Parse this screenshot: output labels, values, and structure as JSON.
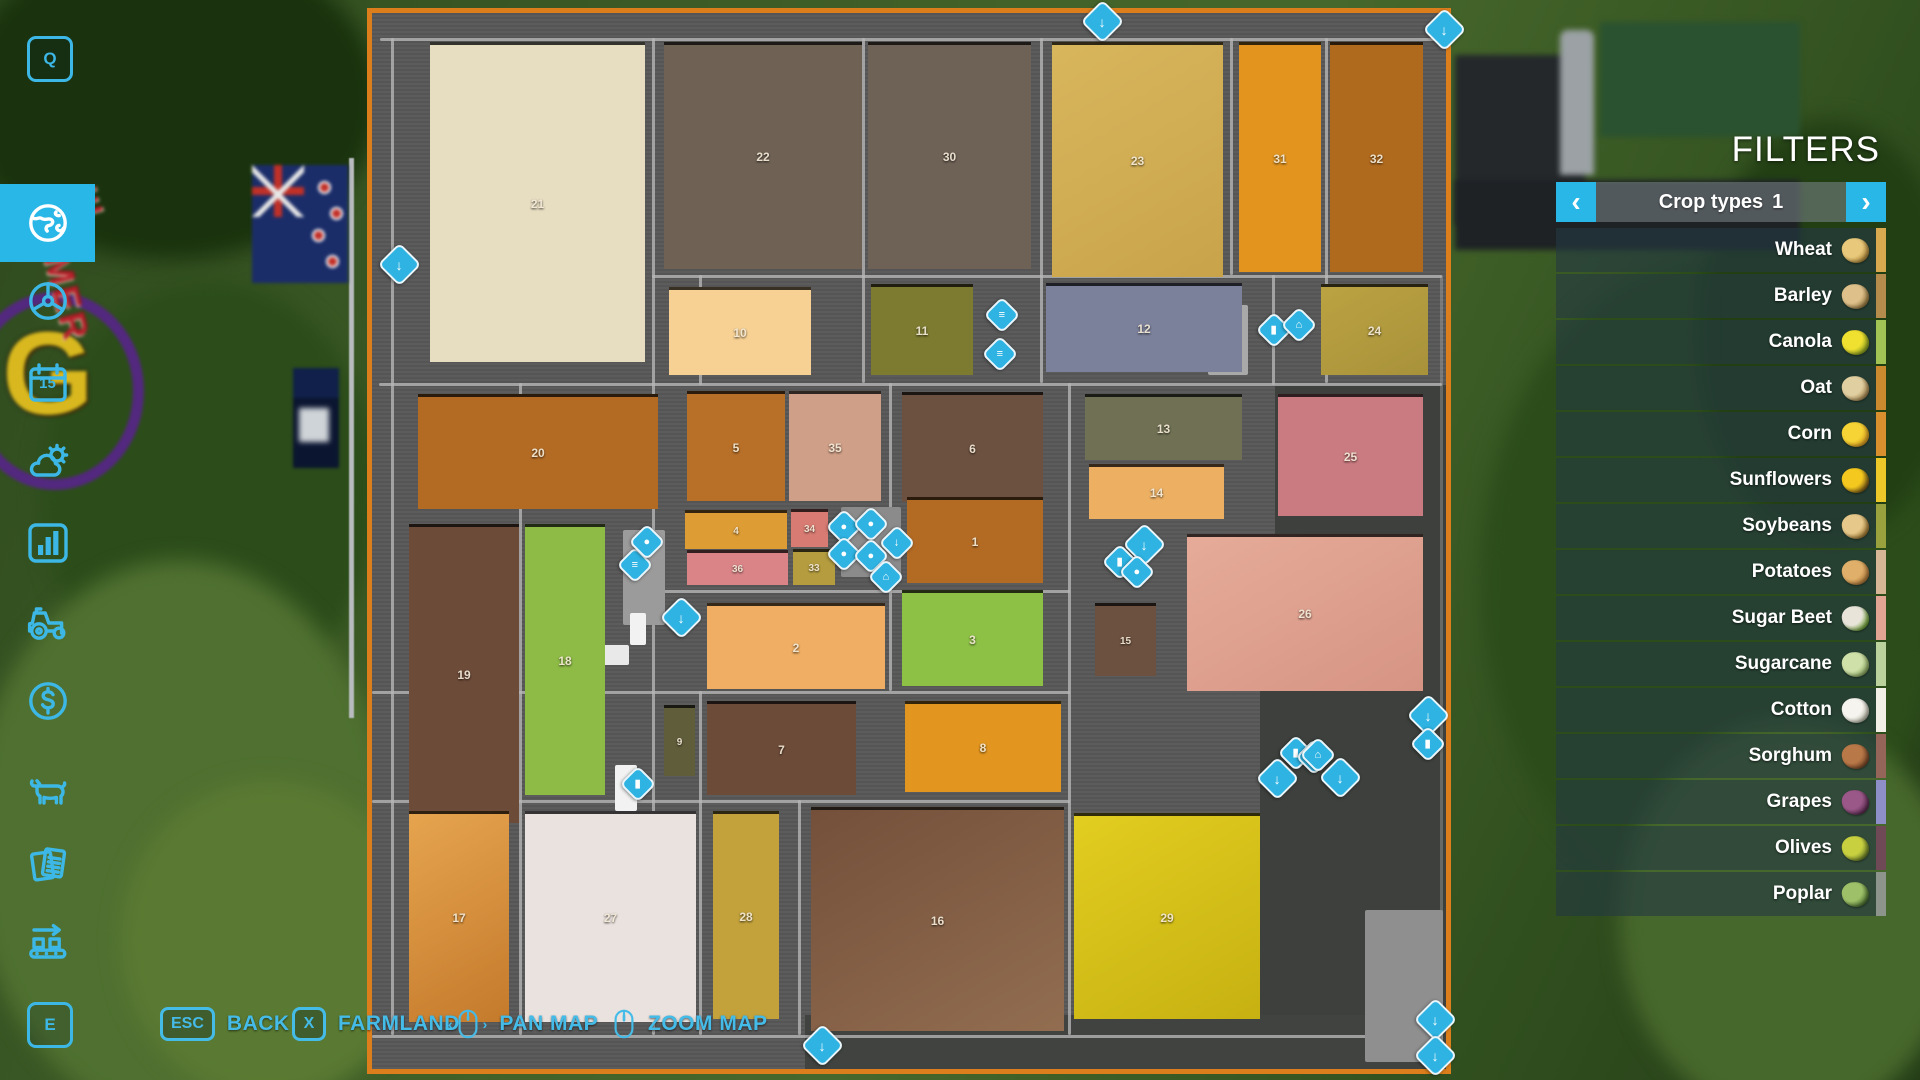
{
  "filters": {
    "title": "FILTERS",
    "selector": {
      "label": "Crop types",
      "page": "1",
      "prev": "‹",
      "next": "›"
    },
    "items": [
      {
        "label": "Wheat",
        "stripe": "#d9a94f",
        "icon": [
          "#e8c87a",
          "#b08a3a"
        ]
      },
      {
        "label": "Barley",
        "stripe": "#b68c4d",
        "icon": [
          "#ddc08a",
          "#9a7a40"
        ]
      },
      {
        "label": "Canola",
        "stripe": "#a2c455",
        "icon": [
          "#f0e030",
          "#88a020"
        ]
      },
      {
        "label": "Oat",
        "stripe": "#cc8a2e",
        "icon": [
          "#e0cfa0",
          "#a88850"
        ]
      },
      {
        "label": "Corn",
        "stripe": "#d98f2e",
        "icon": [
          "#f6d435",
          "#d89a20"
        ]
      },
      {
        "label": "Sunflowers",
        "stripe": "#ecc929",
        "icon": [
          "#f4c81e",
          "#7a5a18"
        ]
      },
      {
        "label": "Soybeans",
        "stripe": "#9aa23e",
        "icon": [
          "#e6c88a",
          "#a07830"
        ]
      },
      {
        "label": "Potatoes",
        "stripe": "#d6b694",
        "icon": [
          "#e0b06a",
          "#b07838"
        ]
      },
      {
        "label": "Sugar Beet",
        "stripe": "#e2a493",
        "icon": [
          "#e8e4da",
          "#6aa030"
        ]
      },
      {
        "label": "Sugarcane",
        "stripe": "#bcd29c",
        "icon": [
          "#cfe0a8",
          "#8aa860"
        ]
      },
      {
        "label": "Cotton",
        "stripe": "#f2efe6",
        "icon": [
          "#f6f4ee",
          "#b8b8a8"
        ]
      },
      {
        "label": "Sorghum",
        "stripe": "#96655a",
        "icon": [
          "#b87848",
          "#7a4828"
        ]
      },
      {
        "label": "Grapes",
        "stripe": "#8e8ec8",
        "icon": [
          "#9a5888",
          "#5a2a50"
        ]
      },
      {
        "label": "Olives",
        "stripe": "#6f4a56",
        "icon": [
          "#c8d040",
          "#6a8028"
        ]
      },
      {
        "label": "Poplar",
        "stripe": "#8d948c",
        "icon": [
          "#9ec068",
          "#4a7030"
        ]
      }
    ]
  },
  "sidebar": {
    "top_key": "Q",
    "bottom_key": "E",
    "items": [
      {
        "id": "map",
        "icon": "globe",
        "active": true,
        "y": 184
      },
      {
        "id": "ai-workers",
        "icon": "wheel",
        "active": false,
        "y": 262
      },
      {
        "id": "calendar",
        "icon": "calendar",
        "active": false,
        "y": 344,
        "label": "15"
      },
      {
        "id": "weather",
        "icon": "weather",
        "active": false,
        "y": 424
      },
      {
        "id": "statistics",
        "icon": "chart",
        "active": false,
        "y": 504
      },
      {
        "id": "vehicles",
        "icon": "tractor",
        "active": false,
        "y": 584
      },
      {
        "id": "finances",
        "icon": "dollar",
        "active": false,
        "y": 662
      },
      {
        "id": "animals",
        "icon": "cow",
        "active": false,
        "y": 752
      },
      {
        "id": "contracts",
        "icon": "contracts",
        "active": false,
        "y": 826
      },
      {
        "id": "production",
        "icon": "production",
        "active": false,
        "y": 902
      }
    ]
  },
  "bottom_bar": {
    "back_key": "ESC",
    "back_label": "BACK",
    "farmland_key": "X",
    "farmland_label": "FARMLAND",
    "pan_label": "PAN MAP",
    "zoom_label": "ZOOM MAP"
  },
  "map": {
    "border_color": "#dd7e1c",
    "accent_color": "#2eb3e2",
    "fields": [
      {
        "n": "21",
        "x": 58,
        "y": 29,
        "w": 215,
        "h": 320,
        "c": "#e7ddc1"
      },
      {
        "n": "22",
        "x": 292,
        "y": 29,
        "w": 198,
        "h": 227,
        "c": "#6f6255"
      },
      {
        "n": "30",
        "x": 496,
        "y": 29,
        "w": 163,
        "h": 227,
        "c": "#6e6156"
      },
      {
        "n": "23",
        "x": 680,
        "y": 29,
        "w": 171,
        "h": 235,
        "c": "#d8b65c",
        "c2": "#c9a34a"
      },
      {
        "n": "31",
        "x": 867,
        "y": 29,
        "w": 82,
        "h": 230,
        "c": "#e2941e"
      },
      {
        "n": "32",
        "x": 958,
        "y": 29,
        "w": 93,
        "h": 230,
        "c": "#b06a1e"
      },
      {
        "n": "10",
        "x": 297,
        "y": 274,
        "w": 142,
        "h": 88,
        "c": "#f7d093"
      },
      {
        "n": "11",
        "x": 499,
        "y": 271,
        "w": 102,
        "h": 91,
        "c": "#7c7b30"
      },
      {
        "n": "12",
        "x": 674,
        "y": 270,
        "w": 196,
        "h": 89,
        "c": "#7b809b"
      },
      {
        "n": "24",
        "x": 949,
        "y": 271,
        "w": 107,
        "h": 91,
        "c": "#bba242",
        "c2": "#a8923a"
      },
      {
        "n": "20",
        "x": 46,
        "y": 381,
        "w": 240,
        "h": 115,
        "c": "#b36b24"
      },
      {
        "n": "5",
        "x": 315,
        "y": 378,
        "w": 98,
        "h": 110,
        "c": "#b87028"
      },
      {
        "n": "35",
        "x": 417,
        "y": 378,
        "w": 92,
        "h": 110,
        "c": "#d09f87"
      },
      {
        "n": "6",
        "x": 530,
        "y": 379,
        "w": 141,
        "h": 110,
        "c": "#6d5140"
      },
      {
        "n": "13",
        "x": 713,
        "y": 381,
        "w": 157,
        "h": 66,
        "c": "#707054"
      },
      {
        "n": "14",
        "x": 717,
        "y": 451,
        "w": 135,
        "h": 55,
        "c": "#edb063"
      },
      {
        "n": "25",
        "x": 906,
        "y": 381,
        "w": 145,
        "h": 122,
        "c": "#ca7b81"
      },
      {
        "n": "4",
        "x": 313,
        "y": 497,
        "w": 102,
        "h": 39,
        "c": "#de9c34",
        "tiny": true
      },
      {
        "n": "34",
        "x": 419,
        "y": 496,
        "w": 37,
        "h": 38,
        "c": "#d87b73",
        "tiny": true
      },
      {
        "n": "36",
        "x": 315,
        "y": 537,
        "w": 101,
        "h": 35,
        "c": "#da8488",
        "tiny": true
      },
      {
        "n": "33",
        "x": 421,
        "y": 536,
        "w": 42,
        "h": 36,
        "c": "#b59d3f",
        "tiny": true
      },
      {
        "n": "1",
        "x": 535,
        "y": 484,
        "w": 136,
        "h": 86,
        "c": "#b36b24"
      },
      {
        "n": "26",
        "x": 815,
        "y": 521,
        "w": 236,
        "h": 157,
        "c": "#e6ab99",
        "c2": "#d69484"
      },
      {
        "n": "15",
        "x": 723,
        "y": 590,
        "w": 61,
        "h": 73,
        "c": "#6d5140",
        "tiny": true
      },
      {
        "n": "19",
        "x": 37,
        "y": 511,
        "w": 110,
        "h": 299,
        "c": "#6d4b39"
      },
      {
        "n": "18",
        "x": 153,
        "y": 511,
        "w": 80,
        "h": 271,
        "c": "#8dbb46"
      },
      {
        "n": "2",
        "x": 335,
        "y": 590,
        "w": 178,
        "h": 86,
        "c": "#efae63"
      },
      {
        "n": "3",
        "x": 530,
        "y": 577,
        "w": 141,
        "h": 96,
        "c": "#8dc145"
      },
      {
        "n": "9",
        "x": 292,
        "y": 692,
        "w": 31,
        "h": 71,
        "c": "#605d3b",
        "tiny": true
      },
      {
        "n": "7",
        "x": 335,
        "y": 688,
        "w": 149,
        "h": 94,
        "c": "#6d4b39"
      },
      {
        "n": "8",
        "x": 533,
        "y": 688,
        "w": 156,
        "h": 91,
        "c": "#e2951f"
      },
      {
        "n": "17",
        "x": 37,
        "y": 798,
        "w": 100,
        "h": 211,
        "c": "#e6a44f",
        "c2": "#c47a2b"
      },
      {
        "n": "27",
        "x": 153,
        "y": 798,
        "w": 171,
        "h": 211,
        "c": "#eae2de"
      },
      {
        "n": "28",
        "x": 341,
        "y": 798,
        "w": 66,
        "h": 208,
        "c": "#c3a23b"
      },
      {
        "n": "16",
        "x": 439,
        "y": 794,
        "w": 253,
        "h": 224,
        "c": "#74503b",
        "c2": "#926d50"
      },
      {
        "n": "29",
        "x": 702,
        "y": 800,
        "w": 186,
        "h": 206,
        "c": "#e2cd20",
        "c2": "#c6b112"
      }
    ],
    "zones": [
      [
        903,
        372,
        171,
        684,
        "#3d403c"
      ],
      [
        888,
        652,
        186,
        404,
        "#3d403c"
      ],
      [
        433,
        1002,
        641,
        54,
        "#40433f"
      ]
    ],
    "roads": {
      "h": [
        [
          8,
          25,
          1062
        ],
        [
          280,
          262,
          790
        ],
        [
          7,
          370,
          1063
        ],
        [
          283,
          577,
          415
        ],
        [
          0,
          678,
          698
        ],
        [
          0,
          787,
          698
        ],
        [
          0,
          1022,
          1070
        ]
      ],
      "v": [
        [
          19,
          25,
          997
        ],
        [
          280,
          25,
          997
        ],
        [
          490,
          25,
          345
        ],
        [
          668,
          25,
          345
        ],
        [
          858,
          25,
          237
        ],
        [
          953,
          25,
          345
        ],
        [
          696,
          370,
          652
        ],
        [
          517,
          370,
          308
        ],
        [
          147,
          370,
          652
        ],
        [
          327,
          262,
          110
        ],
        [
          327,
          678,
          344
        ],
        [
          426,
          787,
          235
        ],
        [
          900,
          262,
          110
        ]
      ],
      "v_dim": [
        [
          1068,
          262,
          758
        ]
      ]
    },
    "structures": [
      [
        251,
        517,
        42,
        95,
        "#9b9b9b"
      ],
      [
        231,
        632,
        26,
        20,
        "#e9e9e9"
      ],
      [
        258,
        600,
        16,
        32,
        "#f2f2f2"
      ],
      [
        243,
        752,
        22,
        46,
        "#f2f2f2"
      ],
      [
        469,
        494,
        60,
        70,
        "#8b8b8b"
      ],
      [
        836,
        292,
        40,
        70,
        "#a9a9a9"
      ],
      [
        993,
        897,
        78,
        152,
        "#8f8f8f"
      ]
    ],
    "markers": [
      {
        "t": "download-station",
        "g": "↓",
        "x": 728,
        "y": 6,
        "big": true
      },
      {
        "t": "download-station",
        "g": "↓",
        "x": 1070,
        "y": 14,
        "big": true
      },
      {
        "t": "download-station",
        "g": "↓",
        "x": 25,
        "y": 249,
        "big": true
      },
      {
        "t": "download-station",
        "g": "↓",
        "x": 307,
        "y": 602,
        "big": true
      },
      {
        "t": "download-station",
        "g": "↓",
        "x": 770,
        "y": 529,
        "big": true
      },
      {
        "t": "download-station",
        "g": "↓",
        "x": 1054,
        "y": 700,
        "big": true
      },
      {
        "t": "download-station",
        "g": "↓",
        "x": 903,
        "y": 763,
        "big": true
      },
      {
        "t": "download-station",
        "g": "↓",
        "x": 966,
        "y": 762,
        "big": true
      },
      {
        "t": "download-station",
        "g": "↓",
        "x": 448,
        "y": 1030,
        "big": true
      },
      {
        "t": "download-station",
        "g": "↓",
        "x": 1061,
        "y": 1004,
        "big": true
      },
      {
        "t": "download-station",
        "g": "↓",
        "x": 1061,
        "y": 1040,
        "big": true
      },
      {
        "t": "download-station",
        "g": "↓",
        "x": 523,
        "y": 528,
        "big": false
      },
      {
        "t": "fuel-station",
        "g": "▮",
        "x": 900,
        "y": 315,
        "big": false
      },
      {
        "t": "fuel-station",
        "g": "▮",
        "x": 746,
        "y": 547,
        "big": false
      },
      {
        "t": "fuel-station",
        "g": "▮",
        "x": 1054,
        "y": 729,
        "big": false
      },
      {
        "t": "fuel-station",
        "g": "▮",
        "x": 264,
        "y": 769,
        "big": false
      },
      {
        "t": "fuel-station",
        "g": "▮",
        "x": 922,
        "y": 738,
        "big": false
      },
      {
        "t": "train-station",
        "g": "≡",
        "x": 628,
        "y": 300,
        "big": false
      },
      {
        "t": "train-station",
        "g": "≡",
        "x": 626,
        "y": 339,
        "big": false
      },
      {
        "t": "train-station",
        "g": "≡",
        "x": 261,
        "y": 550,
        "big": false
      },
      {
        "t": "train-station",
        "g": "≡",
        "x": 940,
        "y": 742,
        "big": false
      },
      {
        "t": "shop",
        "g": "⌂",
        "x": 925,
        "y": 310,
        "big": false
      },
      {
        "t": "shop",
        "g": "⌂",
        "x": 944,
        "y": 740,
        "big": false
      },
      {
        "t": "cow-pen",
        "g": "●",
        "x": 470,
        "y": 512,
        "big": false
      },
      {
        "t": "pig-pen",
        "g": "●",
        "x": 497,
        "y": 509,
        "big": false
      },
      {
        "t": "sheep-pen",
        "g": "●",
        "x": 470,
        "y": 539,
        "big": false
      },
      {
        "t": "chicken-coop",
        "g": "●",
        "x": 497,
        "y": 541,
        "big": false
      },
      {
        "t": "shop",
        "g": "⌂",
        "x": 512,
        "y": 562,
        "big": false
      },
      {
        "t": "vehicle-shop",
        "g": "●",
        "x": 273,
        "y": 527,
        "big": false
      },
      {
        "t": "water-station",
        "g": "●",
        "x": 763,
        "y": 557,
        "big": false
      }
    ]
  }
}
